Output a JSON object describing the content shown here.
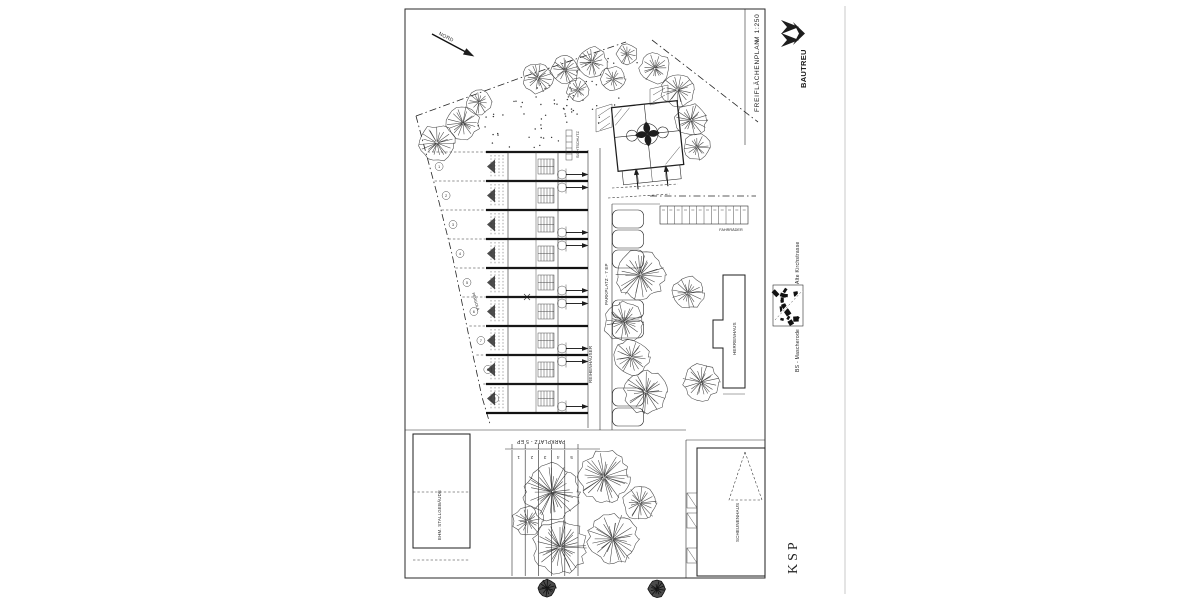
{
  "sheet": {
    "title": "FREIFLÄCHENPLAN",
    "scale": "M 1:250",
    "logo": "BAUTREU",
    "architect": "KSP",
    "street_label": "Alte Kirchstrasse",
    "city_label": "BS - Mascherode",
    "north_label": "NORD"
  },
  "plan": {
    "labels": {
      "row_houses": "REIHENHÄUSER",
      "parking_mid": "PARKPLATZ - 7 EP",
      "parking_bottom": "PARKPLATZ - 5 EP",
      "bikes": "FAHRRÄDER",
      "screen": "SICHTSCHUTZ",
      "pergola": "PERGOLA",
      "manor": "HERRENHAUS",
      "stable": "EHM. STALLGEBÄUDE",
      "barn": "SCHEUNENHAUS"
    },
    "parking_bottom_numbers": [
      "1",
      "2",
      "3",
      "4",
      "5"
    ],
    "garden_plot_numbers": [
      "1",
      "2",
      "3",
      "4",
      "5",
      "6",
      "7",
      "8",
      "9"
    ],
    "house_unit_count": 9,
    "bike_stall_count": 12,
    "mid_parking_bay_ys": [
      210,
      230,
      250,
      300,
      320,
      388,
      408
    ],
    "bottom_stall_xs": [
      512,
      525.2,
      538.4,
      551.6,
      564.8,
      578
    ],
    "trees": [
      [
        538,
        78,
        16
      ],
      [
        565,
        70,
        15
      ],
      [
        592,
        62,
        16
      ],
      [
        613,
        79,
        13
      ],
      [
        578,
        90,
        12
      ],
      [
        627,
        54,
        11
      ],
      [
        655,
        68,
        16
      ],
      [
        678,
        90,
        18
      ],
      [
        691,
        120,
        17
      ],
      [
        697,
        147,
        14
      ],
      [
        437,
        143,
        19
      ],
      [
        463,
        123,
        17
      ],
      [
        479,
        102,
        13
      ],
      [
        640,
        275,
        26
      ],
      [
        624,
        322,
        21
      ],
      [
        631,
        357,
        19
      ],
      [
        646,
        392,
        23
      ],
      [
        701,
        382,
        19
      ],
      [
        688,
        293,
        17
      ],
      [
        552,
        492,
        29
      ],
      [
        604,
        477,
        27
      ],
      [
        560,
        547,
        28
      ],
      [
        613,
        539,
        26
      ],
      [
        640,
        503,
        18
      ],
      [
        528,
        521,
        16
      ]
    ],
    "trees_dark": [
      [
        547,
        588,
        9
      ],
      [
        657,
        589,
        9
      ]
    ]
  },
  "colors": {
    "ink": "#2a2a2a",
    "paper": "#ffffff"
  }
}
